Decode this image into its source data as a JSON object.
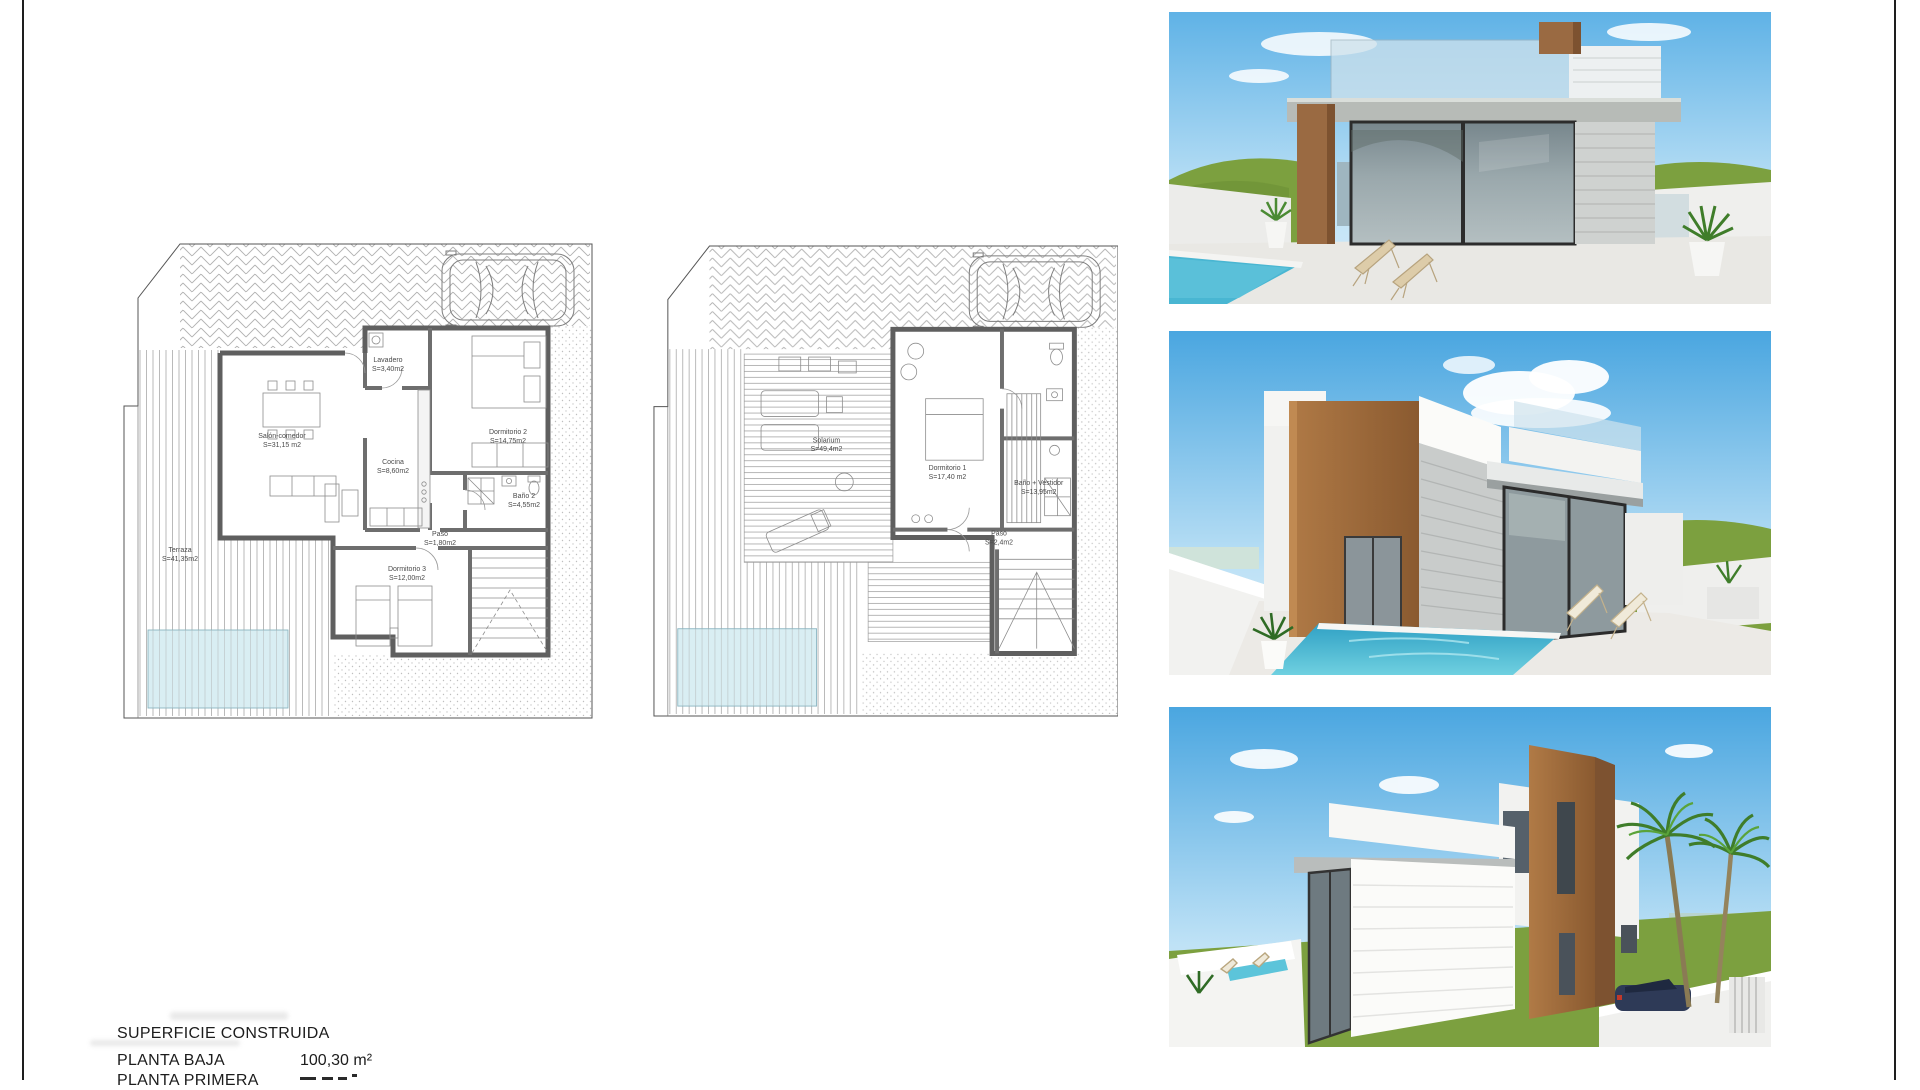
{
  "sheet": {
    "type": "architectural-presentation-sheet",
    "border_color": "#1e1e1e",
    "background": "#ffffff"
  },
  "plans": {
    "ground_floor": {
      "name": "planta-baja-floor-plan",
      "rooms": [
        {
          "label": "Salón-comedor",
          "area": "S=31,15 m2"
        },
        {
          "label": "Cocina",
          "area": "S=8,60m2"
        },
        {
          "label": "Lavadero",
          "area": "S=3,40m2"
        },
        {
          "label": "Dormitorio 2",
          "area": "S=14,75m2"
        },
        {
          "label": "Baño 2",
          "area": "S=4,55m2"
        },
        {
          "label": "Paso",
          "area": "S=1,80m2"
        },
        {
          "label": "Dormitorio 3",
          "area": "S=12,00m2"
        },
        {
          "label": "Terraza",
          "area": "S=41,35m2"
        }
      ]
    },
    "first_floor": {
      "name": "planta-primera-floor-plan",
      "rooms": [
        {
          "label": "Solarium",
          "area": "S=49,4m2"
        },
        {
          "label": "Dormitorio 1",
          "area": "S=17,40 m2"
        },
        {
          "label": "Baño + Vestidor",
          "area": "S=13,95m2"
        },
        {
          "label": "Paso",
          "area": "S=2,4m2"
        }
      ]
    }
  },
  "renders": [
    {
      "name": "villa-front-pool-terrace-render"
    },
    {
      "name": "villa-corner-pool-render"
    },
    {
      "name": "villa-street-side-render"
    }
  ],
  "summary": {
    "title": "SUPERFICIE CONSTRUIDA",
    "rows": [
      {
        "label": "PLANTA BAJA",
        "value": "100,30 m²"
      },
      {
        "label": "PLANTA PRIMERA",
        "value": ""
      }
    ]
  },
  "colors": {
    "wood": "#9a6a42",
    "plan_pool": "#d9eef3",
    "render_pool": "#35aac8",
    "sky": "#58b0e4",
    "hills": "#7ca03f",
    "glass": "#86939a",
    "wall_grey": "#5f5f5f"
  }
}
